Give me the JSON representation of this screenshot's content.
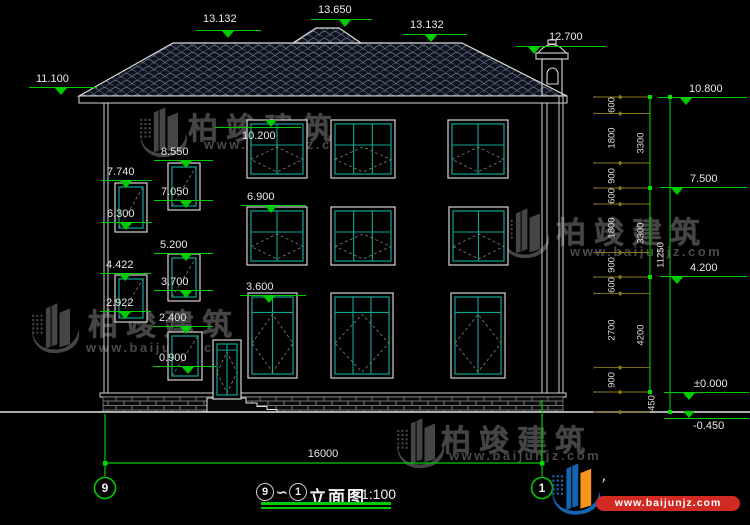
{
  "drawing": {
    "levels": {
      "top": [
        "13.132",
        "13.650",
        "13.132",
        "12.700"
      ],
      "left": [
        "11.100",
        "8.550",
        "7.740",
        "7.050",
        "6.300",
        "5.200",
        "4.422",
        "3.700",
        "2.922",
        "2.400",
        "0.900"
      ],
      "facade": [
        "10.200",
        "6.900",
        "3.600"
      ],
      "right": [
        "10.800",
        "7.500",
        "4.200",
        "±0.000",
        "-0.450"
      ]
    },
    "right_dimensions": {
      "segments": [
        "600",
        "1800",
        "900",
        "600",
        "1800",
        "900",
        "600",
        "2700",
        "900"
      ],
      "floors": [
        "3300",
        "3300",
        "4200"
      ],
      "total": "11250",
      "plinth": "450"
    },
    "bottom_dimension": "16000",
    "grid_bubbles": {
      "left": "9",
      "right": "1"
    },
    "title": {
      "left_circle": "9",
      "connector": "∽",
      "right_circle": "1",
      "name": "立面图",
      "scale": "1:100"
    }
  },
  "watermark": {
    "brand": "柏竣建筑",
    "url": "www.baijunjz.com"
  },
  "logo": {
    "brand": "柏竣建筑",
    "url": "www.baijunjz.com"
  }
}
